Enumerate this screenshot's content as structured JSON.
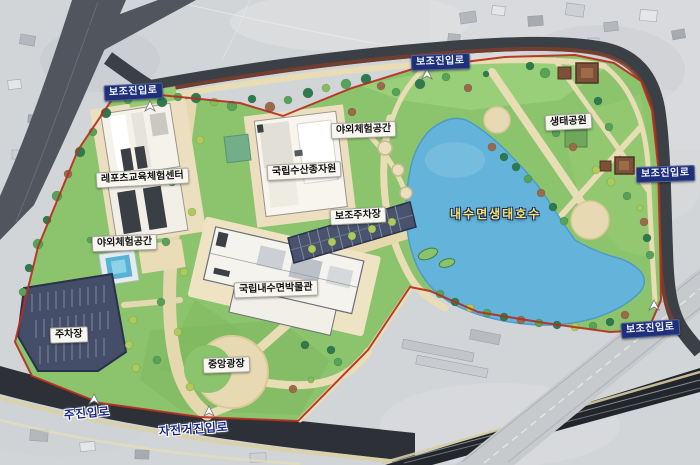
{
  "map": {
    "labels": {
      "aux_entrance": "보조진입로",
      "main_entrance": "주진입로",
      "bike_entrance": "자전거진입로",
      "leports_center": "레포츠교육체험센터",
      "fish_seed_center": "국립수산종자원",
      "outdoor_experience": "야외체험공간",
      "aux_parking": "보조주차장",
      "parking": "주차장",
      "eco_park": "생태공원",
      "lake": "내수면생태호수",
      "museum": "국립내수면박물관",
      "central_plaza": "중앙광장"
    },
    "colors": {
      "park_green": "#8cc46d",
      "lake_blue": "#63b3da",
      "boundary_red": "#b92d1f",
      "road_dark": "#3b3f46",
      "path_tan": "#e9ddb5",
      "parking_navy": "#49536e",
      "label_box_navy": "#1f2f78",
      "label_box_white": "#f8f6f1",
      "lake_text_yellow": "#f2e46a",
      "entrance_text_blue": "#16248c"
    }
  }
}
